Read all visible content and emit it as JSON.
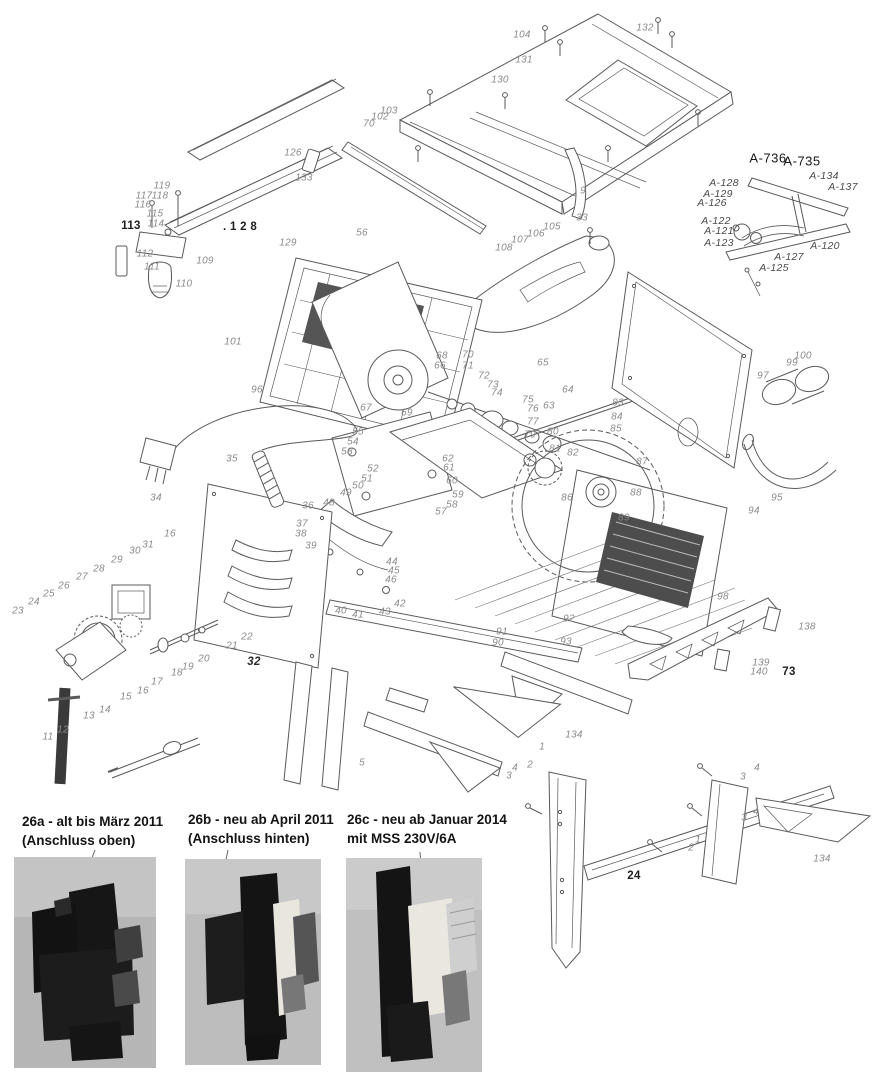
{
  "diagram": {
    "subject": "Tischkreissäge Explosionszeichnung – exploded parts diagram of a table saw",
    "line_color": "#5a5a5a",
    "label_gray": "#8a8a8a",
    "label_dark": "#1d1d1d"
  },
  "part_labels": [
    {
      "t": "104",
      "x": 522,
      "y": 35
    },
    {
      "t": "131",
      "x": 524,
      "y": 60
    },
    {
      "t": "130",
      "x": 500,
      "y": 80
    },
    {
      "t": "132",
      "x": 645,
      "y": 28
    },
    {
      "t": "9",
      "x": 583,
      "y": 191
    },
    {
      "t": "33",
      "x": 582,
      "y": 218
    },
    {
      "t": "103",
      "x": 389,
      "y": 111
    },
    {
      "t": "102",
      "x": 380,
      "y": 117
    },
    {
      "t": "70",
      "x": 369,
      "y": 124
    },
    {
      "t": "126",
      "x": 293,
      "y": 153
    },
    {
      "t": "133",
      "x": 304,
      "y": 178
    },
    {
      "t": "119",
      "x": 162,
      "y": 186
    },
    {
      "t": "117",
      "x": 144,
      "y": 196
    },
    {
      "t": "118",
      "x": 160,
      "y": 196
    },
    {
      "t": "116",
      "x": 143,
      "y": 205
    },
    {
      "t": "115",
      "x": 155,
      "y": 214
    },
    {
      "t": "114",
      "x": 156,
      "y": 224
    },
    {
      "t": "113",
      "x": 131,
      "y": 226,
      "s": "d"
    },
    {
      "t": "112",
      "x": 145,
      "y": 254
    },
    {
      "t": "109",
      "x": 205,
      "y": 261
    },
    {
      "t": "111",
      "x": 152,
      "y": 267
    },
    {
      "t": "110",
      "x": 184,
      "y": 284
    },
    {
      "t": ". 1 2 8",
      "x": 240,
      "y": 227,
      "s": "d"
    },
    {
      "t": "129",
      "x": 288,
      "y": 243
    },
    {
      "t": "56",
      "x": 362,
      "y": 233
    },
    {
      "t": "101",
      "x": 233,
      "y": 342
    },
    {
      "t": "96",
      "x": 257,
      "y": 390
    },
    {
      "t": "A-736",
      "x": 768,
      "y": 158,
      "s": "A"
    },
    {
      "t": "A-735",
      "x": 802,
      "y": 161,
      "s": "A"
    },
    {
      "t": "A-134",
      "x": 824,
      "y": 176,
      "s": "a"
    },
    {
      "t": "A-137",
      "x": 843,
      "y": 187,
      "s": "a"
    },
    {
      "t": "A-128",
      "x": 724,
      "y": 183,
      "s": "a"
    },
    {
      "t": "A-129",
      "x": 718,
      "y": 194,
      "s": "a"
    },
    {
      "t": "A-126",
      "x": 712,
      "y": 203,
      "s": "a"
    },
    {
      "t": "A-122",
      "x": 716,
      "y": 221,
      "s": "a"
    },
    {
      "t": "A-121",
      "x": 719,
      "y": 231,
      "s": "a"
    },
    {
      "t": "A-123",
      "x": 719,
      "y": 243,
      "s": "a"
    },
    {
      "t": "A-120",
      "x": 825,
      "y": 246,
      "s": "a"
    },
    {
      "t": "A-127",
      "x": 789,
      "y": 257,
      "s": "a"
    },
    {
      "t": "A-125",
      "x": 774,
      "y": 268,
      "s": "a"
    },
    {
      "t": "105",
      "x": 552,
      "y": 227
    },
    {
      "t": "106",
      "x": 536,
      "y": 234
    },
    {
      "t": "107",
      "x": 520,
      "y": 240
    },
    {
      "t": "108",
      "x": 504,
      "y": 248
    },
    {
      "t": "35",
      "x": 232,
      "y": 459
    },
    {
      "t": "34",
      "x": 156,
      "y": 498
    },
    {
      "t": "67",
      "x": 366,
      "y": 408
    },
    {
      "t": "68",
      "x": 442,
      "y": 356
    },
    {
      "t": "66",
      "x": 440,
      "y": 366
    },
    {
      "t": "69",
      "x": 407,
      "y": 413
    },
    {
      "t": "70",
      "x": 468,
      "y": 355
    },
    {
      "t": "71",
      "x": 468,
      "y": 366
    },
    {
      "t": "72",
      "x": 484,
      "y": 376
    },
    {
      "t": "73",
      "x": 493,
      "y": 385
    },
    {
      "t": "74",
      "x": 497,
      "y": 393
    },
    {
      "t": "75",
      "x": 528,
      "y": 400
    },
    {
      "t": "76",
      "x": 533,
      "y": 409
    },
    {
      "t": "77",
      "x": 533,
      "y": 422
    },
    {
      "t": "79",
      "x": 530,
      "y": 435
    },
    {
      "t": "80",
      "x": 553,
      "y": 432
    },
    {
      "t": "63",
      "x": 549,
      "y": 406
    },
    {
      "t": "64",
      "x": 568,
      "y": 390
    },
    {
      "t": "65",
      "x": 543,
      "y": 363
    },
    {
      "t": "55",
      "x": 358,
      "y": 432
    },
    {
      "t": "54",
      "x": 353,
      "y": 442
    },
    {
      "t": "53",
      "x": 347,
      "y": 452
    },
    {
      "t": "52",
      "x": 373,
      "y": 469
    },
    {
      "t": "51",
      "x": 367,
      "y": 479
    },
    {
      "t": "50",
      "x": 358,
      "y": 486
    },
    {
      "t": "49",
      "x": 346,
      "y": 493
    },
    {
      "t": "48",
      "x": 329,
      "y": 503
    },
    {
      "t": "62",
      "x": 448,
      "y": 459
    },
    {
      "t": "61",
      "x": 449,
      "y": 468
    },
    {
      "t": "60",
      "x": 452,
      "y": 481
    },
    {
      "t": "59",
      "x": 458,
      "y": 495
    },
    {
      "t": "58",
      "x": 452,
      "y": 505
    },
    {
      "t": "57",
      "x": 441,
      "y": 512
    },
    {
      "t": "36",
      "x": 308,
      "y": 506
    },
    {
      "t": "37",
      "x": 302,
      "y": 524
    },
    {
      "t": "38",
      "x": 301,
      "y": 534
    },
    {
      "t": "39",
      "x": 311,
      "y": 546
    },
    {
      "t": "44",
      "x": 392,
      "y": 562
    },
    {
      "t": "45",
      "x": 394,
      "y": 571
    },
    {
      "t": "46",
      "x": 391,
      "y": 580
    },
    {
      "t": "40",
      "x": 341,
      "y": 611
    },
    {
      "t": "41",
      "x": 358,
      "y": 615
    },
    {
      "t": "43",
      "x": 385,
      "y": 612
    },
    {
      "t": "42",
      "x": 400,
      "y": 604
    },
    {
      "t": "81",
      "x": 555,
      "y": 449
    },
    {
      "t": "82",
      "x": 573,
      "y": 453
    },
    {
      "t": "87",
      "x": 642,
      "y": 462
    },
    {
      "t": "88",
      "x": 636,
      "y": 493
    },
    {
      "t": "86",
      "x": 567,
      "y": 498
    },
    {
      "t": "89",
      "x": 624,
      "y": 518
    },
    {
      "t": "83",
      "x": 618,
      "y": 403
    },
    {
      "t": "84",
      "x": 617,
      "y": 417
    },
    {
      "t": "85",
      "x": 616,
      "y": 429
    },
    {
      "t": "97",
      "x": 763,
      "y": 376
    },
    {
      "t": "99",
      "x": 792,
      "y": 363
    },
    {
      "t": "100",
      "x": 803,
      "y": 356
    },
    {
      "t": "95",
      "x": 777,
      "y": 498
    },
    {
      "t": "94",
      "x": 754,
      "y": 511
    },
    {
      "t": "92",
      "x": 569,
      "y": 619
    },
    {
      "t": "91",
      "x": 502,
      "y": 632
    },
    {
      "t": "90",
      "x": 498,
      "y": 643
    },
    {
      "t": "93",
      "x": 566,
      "y": 642
    },
    {
      "t": "98",
      "x": 723,
      "y": 597
    },
    {
      "t": "138",
      "x": 807,
      "y": 627
    },
    {
      "t": "139",
      "x": 761,
      "y": 663
    },
    {
      "t": "140",
      "x": 759,
      "y": 672
    },
    {
      "t": "73",
      "x": 789,
      "y": 672,
      "s": "d"
    },
    {
      "t": "32",
      "x": 254,
      "y": 662,
      "s": "b"
    },
    {
      "t": "23",
      "x": 18,
      "y": 611
    },
    {
      "t": "24",
      "x": 34,
      "y": 602
    },
    {
      "t": "25",
      "x": 49,
      "y": 594
    },
    {
      "t": "26",
      "x": 64,
      "y": 586
    },
    {
      "t": "27",
      "x": 82,
      "y": 577
    },
    {
      "t": "28",
      "x": 99,
      "y": 569
    },
    {
      "t": "29",
      "x": 117,
      "y": 560
    },
    {
      "t": "30",
      "x": 135,
      "y": 551
    },
    {
      "t": "31",
      "x": 148,
      "y": 545
    },
    {
      "t": "16",
      "x": 170,
      "y": 534
    },
    {
      "t": "22",
      "x": 247,
      "y": 637
    },
    {
      "t": "21",
      "x": 232,
      "y": 646
    },
    {
      "t": "20",
      "x": 204,
      "y": 659
    },
    {
      "t": "19",
      "x": 188,
      "y": 667
    },
    {
      "t": "18",
      "x": 177,
      "y": 673
    },
    {
      "t": "17",
      "x": 157,
      "y": 682
    },
    {
      "t": "16",
      "x": 143,
      "y": 691
    },
    {
      "t": "15",
      "x": 126,
      "y": 697
    },
    {
      "t": "14",
      "x": 105,
      "y": 710
    },
    {
      "t": "13",
      "x": 89,
      "y": 716
    },
    {
      "t": "12",
      "x": 63,
      "y": 730
    },
    {
      "t": "11",
      "x": 48,
      "y": 737
    },
    {
      "t": "134",
      "x": 574,
      "y": 735
    },
    {
      "t": "134",
      "x": 822,
      "y": 859
    },
    {
      "t": "24",
      "x": 634,
      "y": 876,
      "s": "d"
    },
    {
      "t": "1",
      "x": 542,
      "y": 747
    },
    {
      "t": "2",
      "x": 530,
      "y": 765
    },
    {
      "t": "4",
      "x": 515,
      "y": 768
    },
    {
      "t": "3",
      "x": 509,
      "y": 776
    },
    {
      "t": "5",
      "x": 362,
      "y": 763
    },
    {
      "t": "4",
      "x": 757,
      "y": 768
    },
    {
      "t": "3",
      "x": 743,
      "y": 777
    },
    {
      "t": "4",
      "x": 756,
      "y": 812
    },
    {
      "t": "3",
      "x": 744,
      "y": 818
    },
    {
      "t": "1",
      "x": 698,
      "y": 840
    },
    {
      "t": "2",
      "x": 691,
      "y": 848
    }
  ],
  "photos": [
    {
      "id": "26a",
      "line1": "26a - alt bis März 2011",
      "line2": "(Anschluss  oben)"
    },
    {
      "id": "26b",
      "line1": "26b - neu ab April 2011",
      "line2": "(Anschluss  hinten)"
    },
    {
      "id": "26c",
      "line1": "26c - neu ab Januar 2014",
      "line2": "mit  MSS 230V/6A"
    }
  ]
}
